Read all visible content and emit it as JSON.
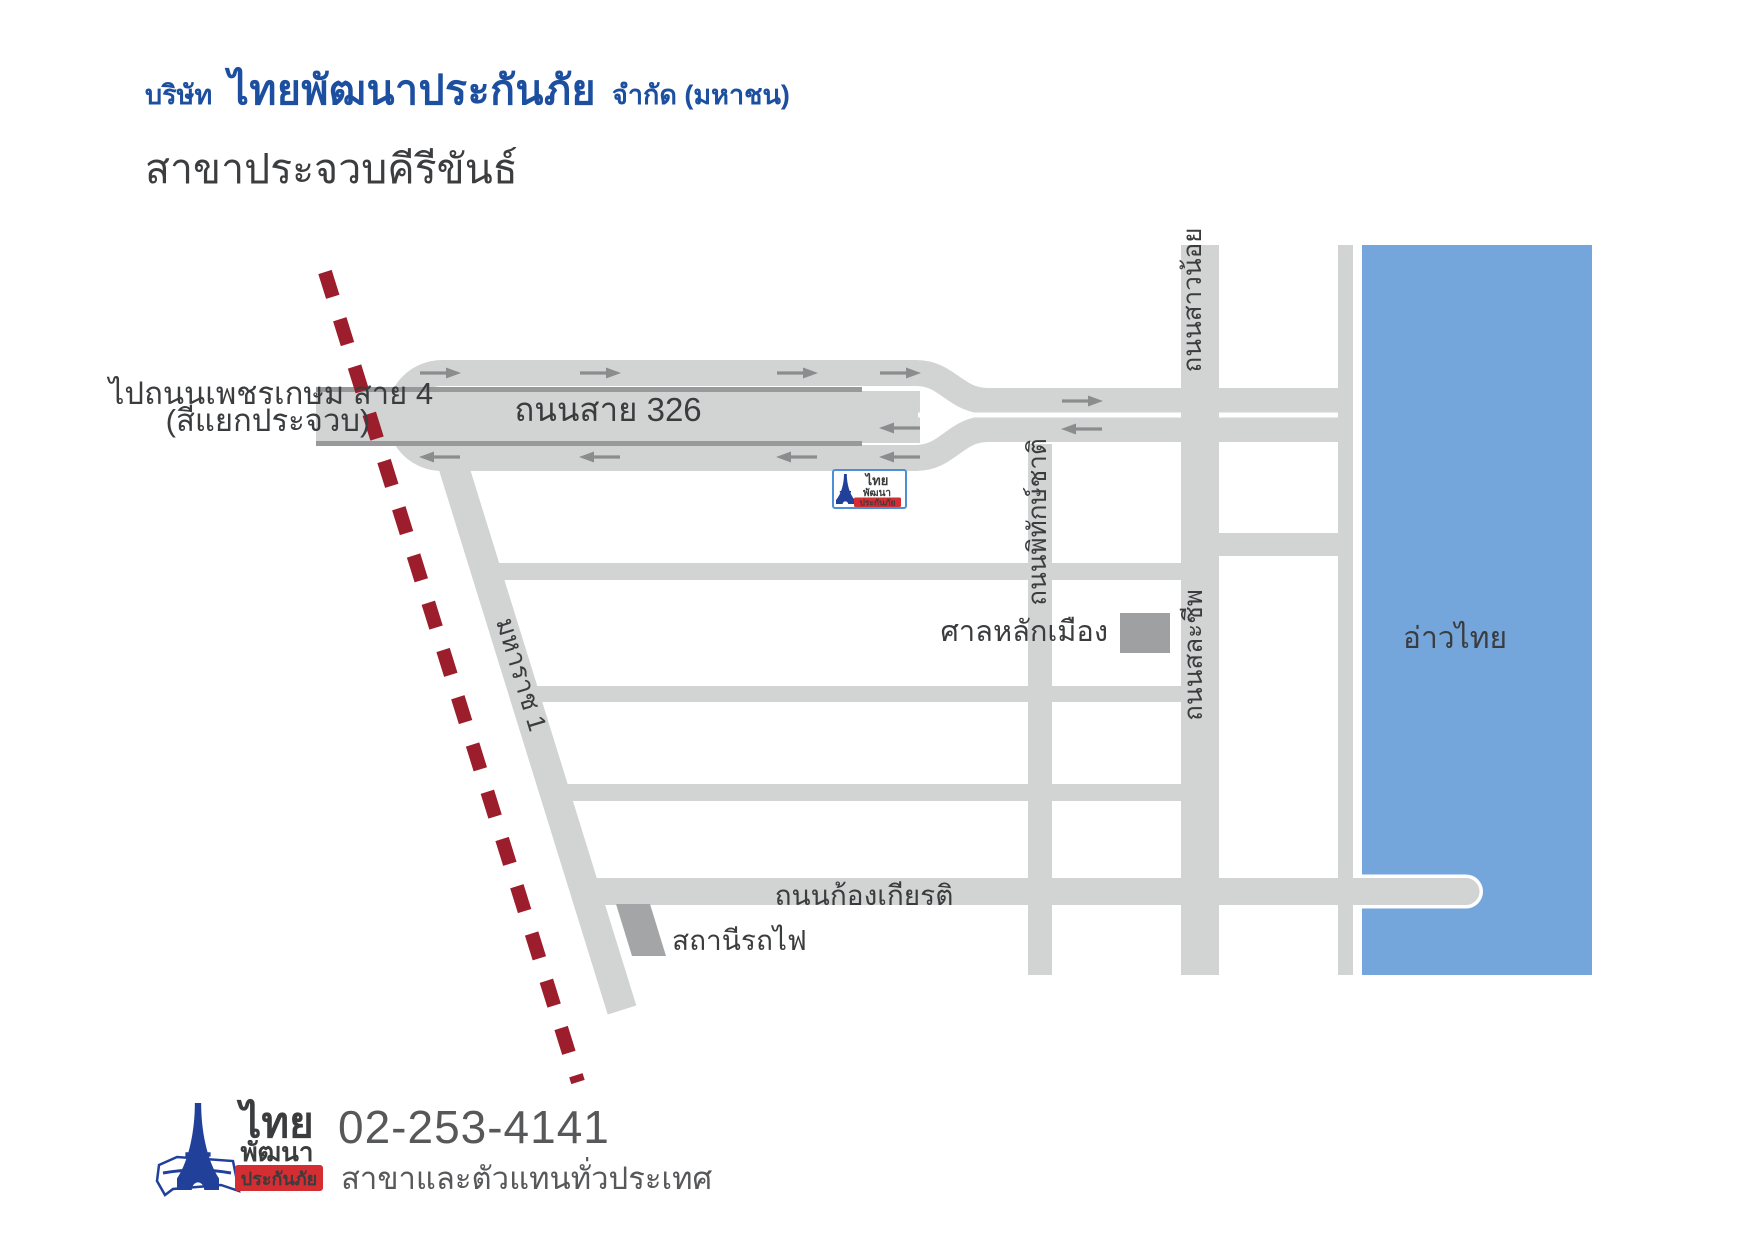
{
  "header": {
    "company_prefix": "บริษัท",
    "company_name": "ไทยพัฒนาประกันภัย",
    "company_suffix": "จำกัด (มหาชน)",
    "branch": "สาขาประจวบคีรีขันธ์"
  },
  "map": {
    "labels": {
      "to_road_line1": "ไปถนนเพชรเกษม สาย 4",
      "to_road_line2": "(สี่แยกประจวบ)",
      "route_326": "ถนนสาย 326",
      "pitakchat": "ถนนพิทักษ์ชาติ",
      "salacheep": "ถนนสละชีพ",
      "saonoi": "ถนนสาวน้อย",
      "maharat": "มหาราช 1",
      "city_pillar": "ศาลหลักเมือง",
      "gulf": "อ่าวไทย",
      "kongkiat": "ถนนก้องเกียรติ",
      "train_station": "สถานีรถไฟ"
    },
    "marker": {
      "line1": "ไทย",
      "line2": "พัฒนา",
      "line3": "ประกันภัย"
    },
    "colors": {
      "road": "#D2D4D4",
      "road_median": "#97999B",
      "arrow": "#8A8C8E",
      "sea": "#74A5DB",
      "railway": "#9C1E2C",
      "building": "#9EA0A2",
      "label_text": "#3B3C3E",
      "header_blue": "#1C4F9F",
      "logo_light_blue": "#5B9BD5",
      "logo_dark_blue": "#21409A",
      "logo_red": "#D42E33",
      "footer_text": "#57585A"
    }
  },
  "footer": {
    "logo": {
      "line1": "ไทย",
      "line2": "พัฒนา",
      "line3": "ประกันภัย"
    },
    "phone": "02-253-4141",
    "tagline": "สาขาและตัวแทนทั่วประเทศ"
  }
}
